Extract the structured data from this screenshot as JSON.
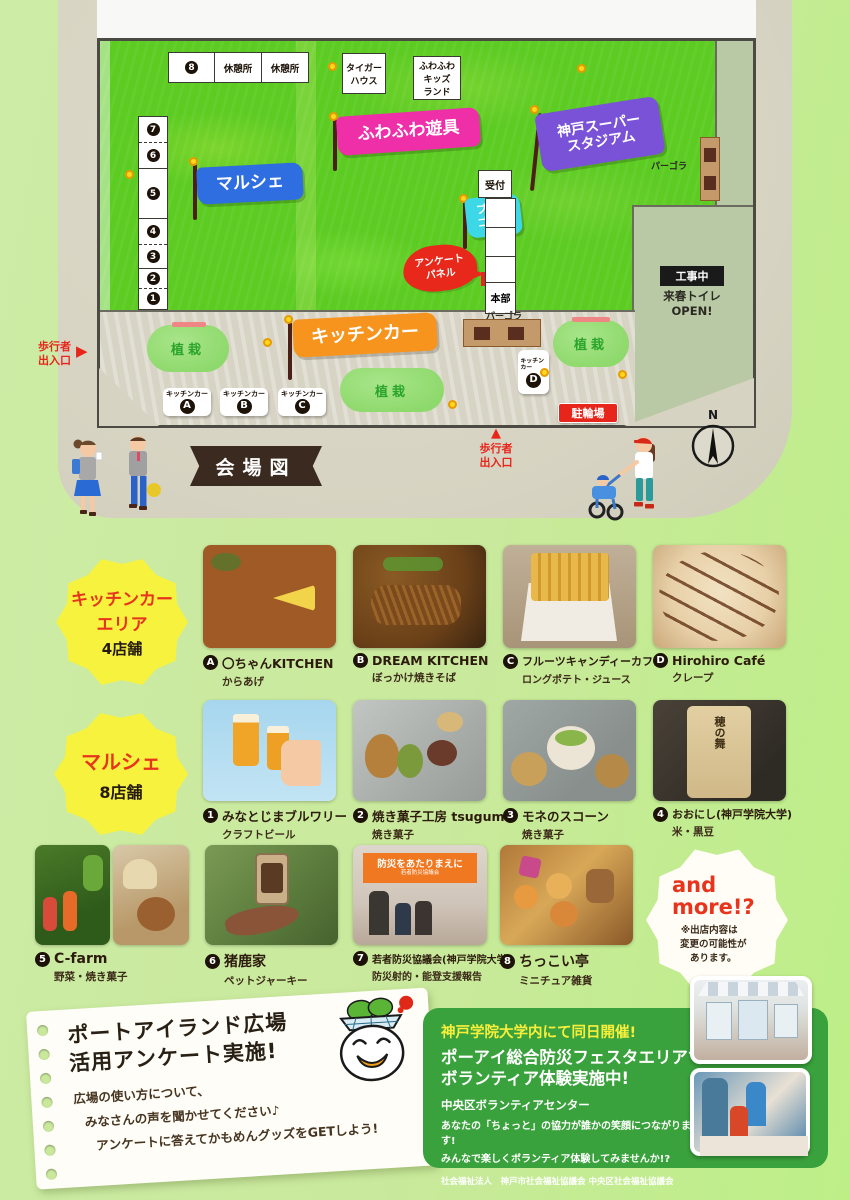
{
  "colors": {
    "page_bg": "#c9e89c",
    "paper": "#d7d3c2",
    "grass": "#5ccb22",
    "flag_marche_blue": "#2e6ee0",
    "flag_fuwafuwa_pink": "#ef2fa8",
    "flag_stadium_purple": "#7a52d8",
    "flag_blowgolf_cyan": "#3cd8e8",
    "banner_kitchen_orange": "#f7941e",
    "alert_red": "#e8251a",
    "badge_yellow": "#f6f23e",
    "accent_red_text": "#e8341c",
    "volunteer_green": "#3aa23c",
    "volunteer_yellow": "#f8ef3c"
  },
  "map": {
    "ribbon": "会場図",
    "number8": "8",
    "rest1": "休憩所",
    "rest2": "休憩所",
    "tiger_line1": "タイガー",
    "tiger_line2": "ハウス",
    "kids_line1": "ふわふわ",
    "kids_line2": "キッズ",
    "kids_line3": "ランド",
    "stall_numbers": [
      "7",
      "6",
      "5",
      "4",
      "3",
      "2",
      "1"
    ],
    "flag_marche": "マルシェ",
    "flag_fuwafuwa": "ふわふわ遊具",
    "flag_stadium_line1": "神戸スーパー",
    "flag_stadium_line2": "スタジアム",
    "flag_blowgolf_line1": "ブロー",
    "flag_blowgolf_line2": "ゴルフ",
    "banner_kitchencar": "キッチンカー",
    "reception": "受付",
    "headquarters": "本部",
    "survey_panel_line1": "アンケート",
    "survey_panel_line2": "パネル",
    "pergola_right": "パーゴラ",
    "pergola_bottom": "パーゴラ",
    "construction": "工事中",
    "toilet_line1": "来春トイレ",
    "toilet_line2": "OPEN!",
    "planting1": "植栽",
    "planting2": "植栽",
    "planting3": "植栽",
    "bike_parking": "駐輪場",
    "kitchen_spots": [
      {
        "label": "キッチンカー",
        "letter": "A"
      },
      {
        "label": "キッチンカー",
        "letter": "B"
      },
      {
        "label": "キッチンカー",
        "letter": "C"
      },
      {
        "label": "キッチンカー",
        "letter": "D"
      }
    ],
    "entrance_left_line1": "歩行者",
    "entrance_left_line2": "出入口",
    "entrance_left_arrow": "▶",
    "entrance_bottom_line1": "歩行者",
    "entrance_bottom_line2": "出入口",
    "entrance_bottom_arrow": "▲",
    "compass_n": "N"
  },
  "kitchen_section": {
    "badge_line1": "キッチンカー",
    "badge_line2": "エリア",
    "badge_line3": "4店舗",
    "items": [
      {
        "letter": "A",
        "name": "〇ちゃんKITCHEN",
        "desc": "からあげ"
      },
      {
        "letter": "B",
        "name": "DREAM KITCHEN",
        "desc": "ぼっかけ焼きそば"
      },
      {
        "letter": "C",
        "name": "フルーツキャンディーカフェ",
        "desc": "ロングポテト・ジュース"
      },
      {
        "letter": "D",
        "name": "Hirohiro Café",
        "desc": "クレープ"
      }
    ]
  },
  "marche_section": {
    "badge_line1": "マルシェ",
    "badge_line2": "8店舗",
    "items": [
      {
        "num": "1",
        "name": "みなとじまブルワリー",
        "desc": "クラフトビール"
      },
      {
        "num": "2",
        "name": "焼き菓子工房 tsugumi",
        "desc": "焼き菓子"
      },
      {
        "num": "3",
        "name": "モネのスコーン",
        "desc": "焼き菓子"
      },
      {
        "num": "4",
        "name": "おおにし(神戸学院大学)",
        "desc": "米・黒豆"
      },
      {
        "num": "5",
        "name": "C-farm",
        "desc": "野菜・焼き菓子"
      },
      {
        "num": "6",
        "name": "猪鹿家",
        "desc": "ペットジャーキー"
      },
      {
        "num": "7",
        "name": "若者防災協議会(神戸学院大学)",
        "desc": "防災射的・能登支援報告"
      },
      {
        "num": "8",
        "name": "ちっこい亭",
        "desc": "ミニチュア雑貨"
      }
    ],
    "photo4_bag_text": "穂の舞",
    "photo7_banner": "防災をあたりまえに",
    "photo7_banner_sub": "若者防災協議会",
    "more_line1": "and",
    "more_line2": "more!?",
    "more_note_line1": "※出店内容は",
    "more_note_line2": "変更の可能性が",
    "more_note_line3": "あります。"
  },
  "survey_note": {
    "title_line1": "ポートアイランド広場",
    "title_line2": "活用アンケート実施!",
    "body_line1": "広場の使い方について、",
    "body_line2": "みなさんの声を聞かせてください♪",
    "body_line3": "アンケートに答えてかもめんグッズをGETしよう!"
  },
  "volunteer_box": {
    "tagline": "神戸学院大学内にて同日開催!",
    "title_line1": "ポーアイ総合防災フェスタエリアで",
    "title_line2": "ボランティア体験実施中!",
    "subtitle": "中央区ボランティアセンター",
    "body_line1": "あなたの「ちょっと」の協力が誰かの笑顔につながります!",
    "body_line2": "みんなで楽しくボランティア体験してみませんか!?",
    "footer": "社会福祉法人　神戸市社会福祉協議会 中央区社会福祉協議会"
  }
}
